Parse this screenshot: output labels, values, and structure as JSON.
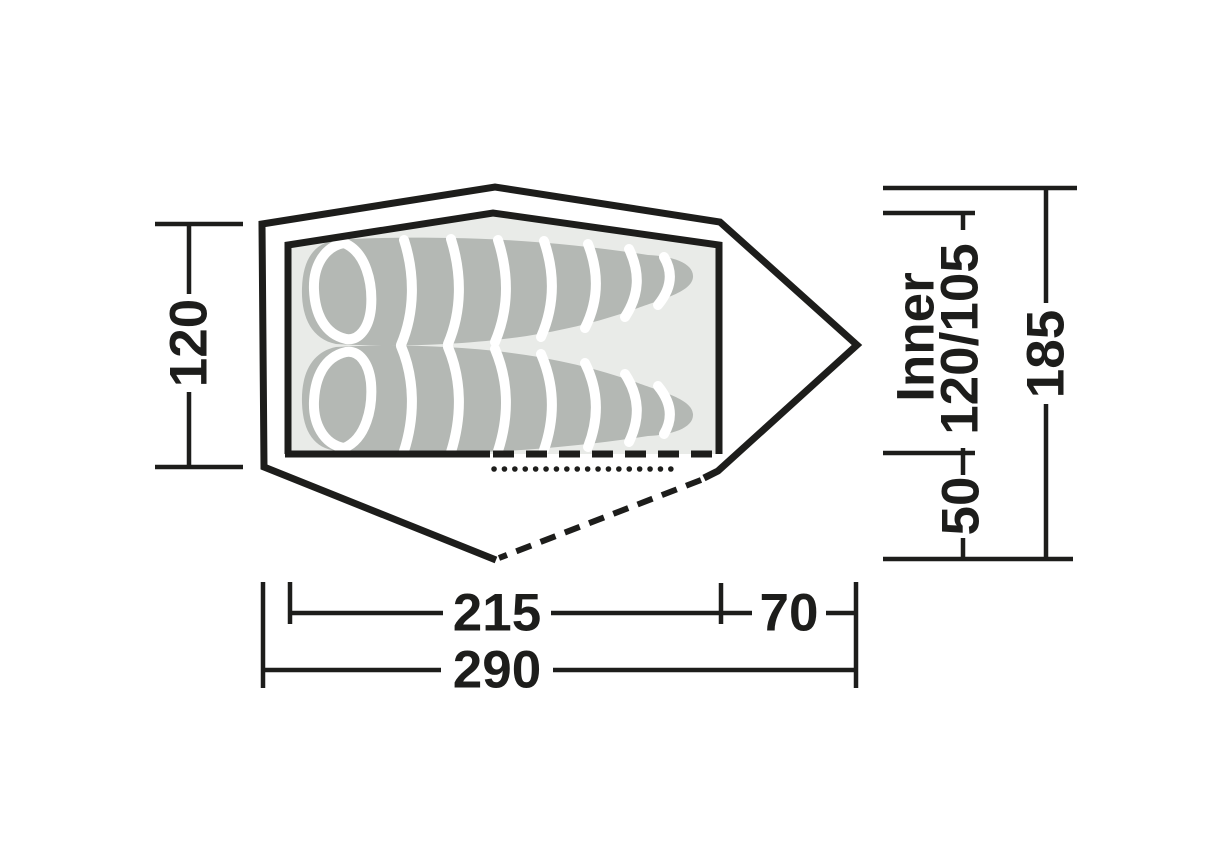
{
  "diagram": {
    "type": "tent-floorplan-top-view",
    "labels": {
      "side_width": "120",
      "inner_length": "215",
      "vestibule_length": "70",
      "total_length": "290",
      "inner_name": "Inner",
      "inner_width": "120/105",
      "vestibule_side_width": "50",
      "total_width": "185"
    },
    "colors": {
      "outline": "#1d1d1b",
      "inner_tent_fill": "#e9ebe8",
      "sleeping_bag_fill": "#b4b8b4",
      "baffle_line": "#ffffff",
      "background": "#ffffff"
    }
  }
}
